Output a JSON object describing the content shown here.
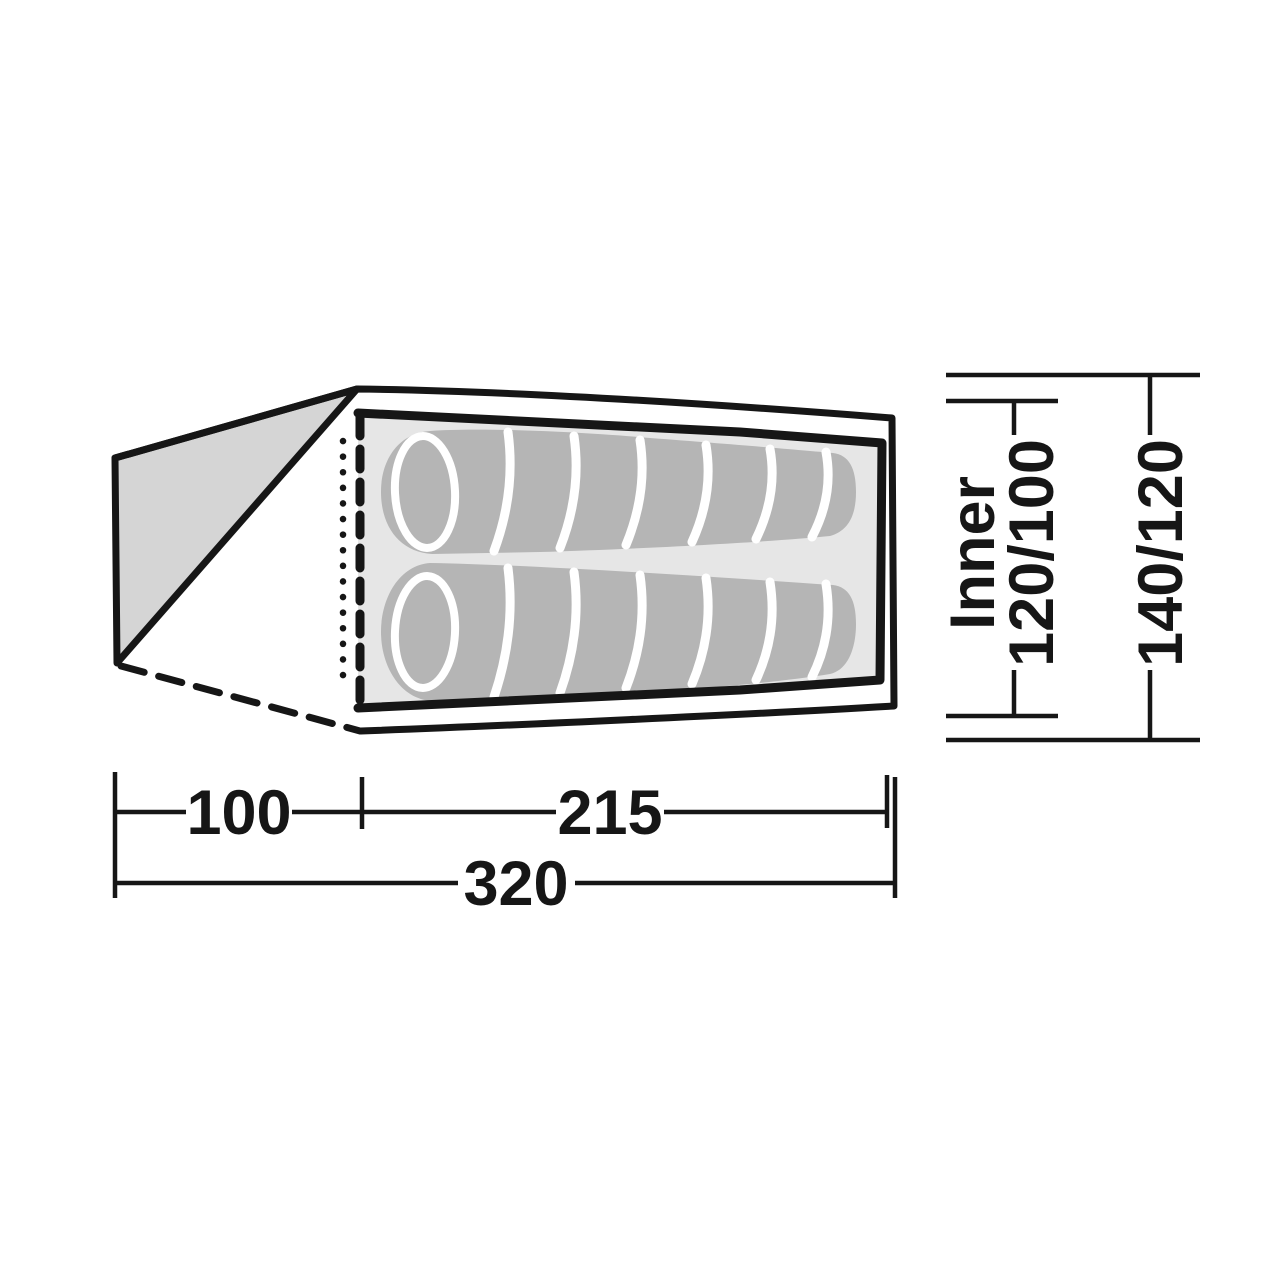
{
  "diagram": {
    "kind": "tent-floorplan-top-view",
    "dims": {
      "vestibule_depth": "100",
      "inner_length": "215",
      "total_length": "320",
      "inner_label": "Inner",
      "inner_width": "120/100",
      "outer_width": "140/120"
    },
    "colors": {
      "line": "#161616",
      "vestibule": "#d5d5d5",
      "floor": "#e6e6e6",
      "bag": "#b5b5b5",
      "background": "#ffffff"
    }
  }
}
